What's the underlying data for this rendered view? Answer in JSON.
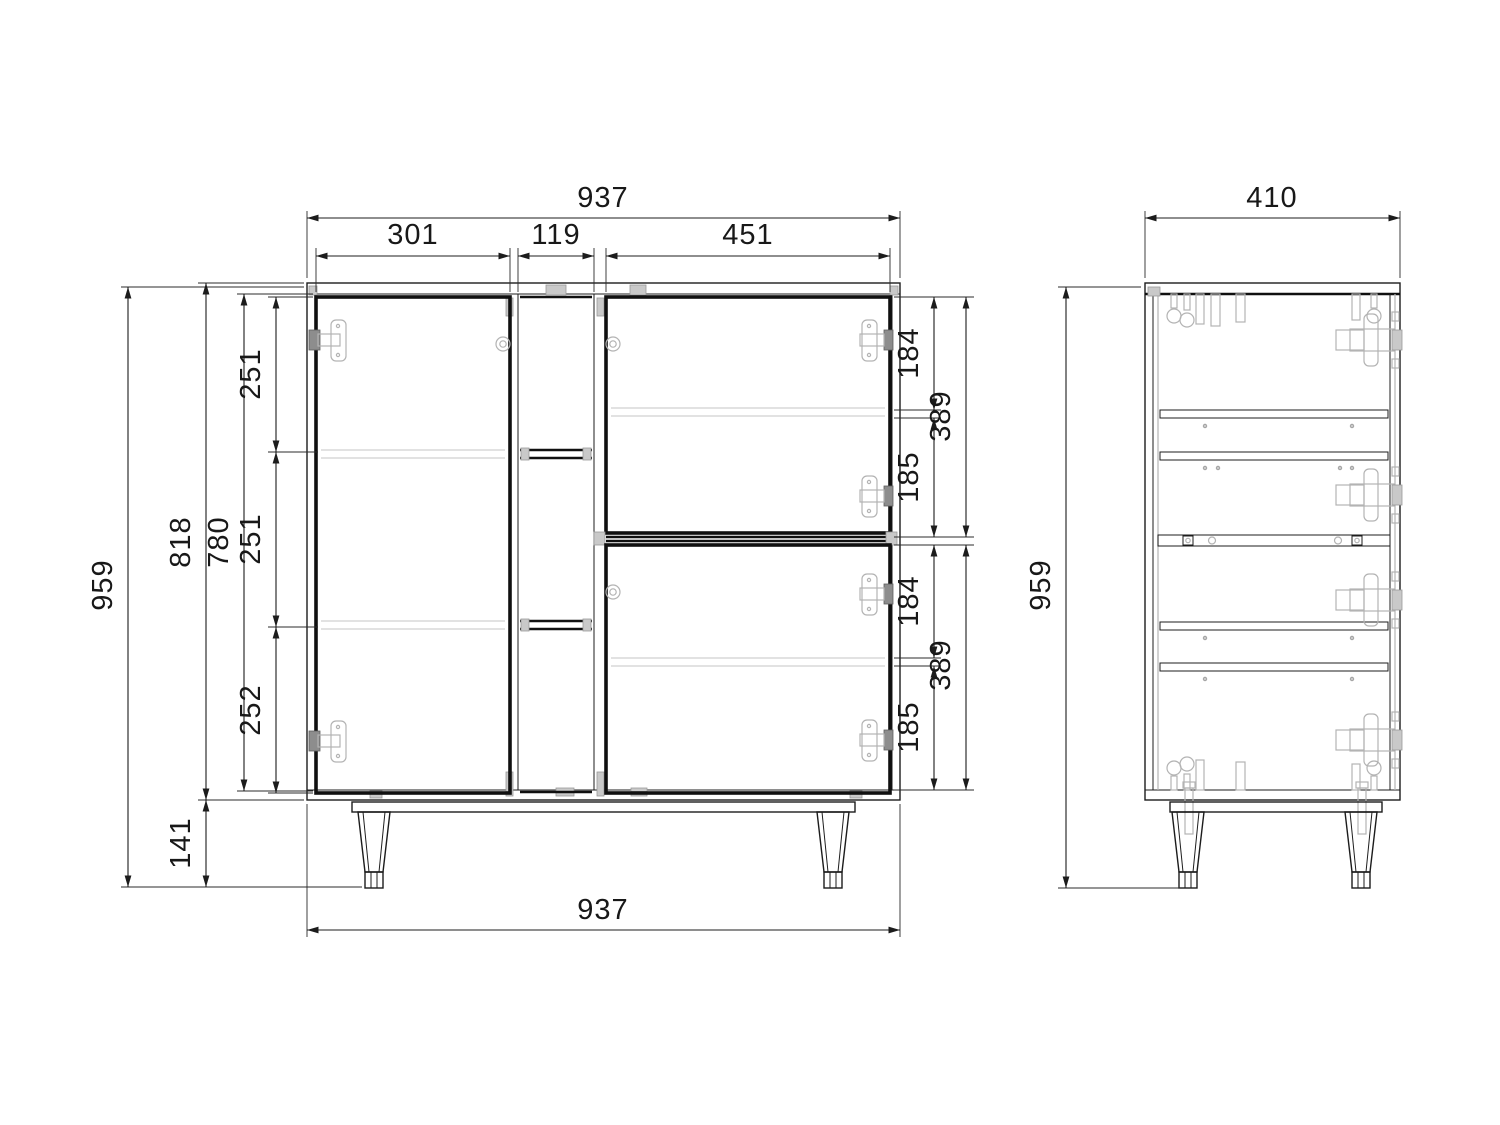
{
  "drawing": {
    "front_view": {
      "dim_total_width_top": "937",
      "dim_section_left": "301",
      "dim_section_middle": "119",
      "dim_section_right": "451",
      "dim_total_height": "959",
      "dim_body_height": "818",
      "dim_inner_height": "780",
      "dim_compartment_top": "251",
      "dim_compartment_middle": "251",
      "dim_compartment_bottom": "252",
      "dim_leg_height": "141",
      "dim_right_upper_a": "184",
      "dim_right_upper_total": "389",
      "dim_right_upper_b": "185",
      "dim_right_lower_a": "184",
      "dim_right_lower_total": "389",
      "dim_right_lower_b": "185",
      "dim_total_width_bottom": "937"
    },
    "side_view": {
      "dim_depth": "410",
      "dim_total_height": "959"
    },
    "colors": {
      "line": "#1c1c1c",
      "hardware": "#c9c9c9",
      "background": "#ffffff"
    }
  }
}
